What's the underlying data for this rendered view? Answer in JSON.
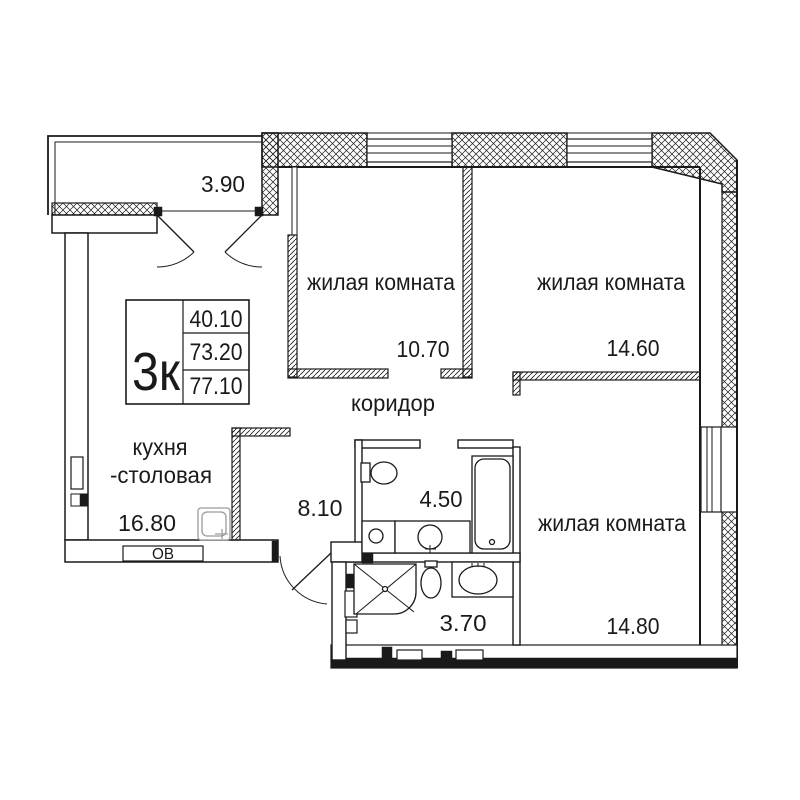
{
  "unit": {
    "type_label": "3к",
    "stats": [
      "40.10",
      "73.20",
      "77.10"
    ]
  },
  "balcony": {
    "area": "3.90"
  },
  "rooms": {
    "living1": {
      "label": "жилая комната",
      "area": "10.70"
    },
    "living2": {
      "label": "жилая комната",
      "area": "14.60"
    },
    "living3": {
      "label": "жилая комната",
      "area": "14.80"
    },
    "kitchen": {
      "label1": "кухня",
      "label2": "-столовая",
      "area": "16.80"
    },
    "corridor": {
      "label": "коридор",
      "area": "8.10"
    },
    "bathroom": {
      "area": "4.50"
    },
    "wc": {
      "area": "3.70"
    }
  },
  "annotations": {
    "heating": "ОВ"
  },
  "colors": {
    "line": "#1a1a1a",
    "bg": "#ffffff"
  }
}
